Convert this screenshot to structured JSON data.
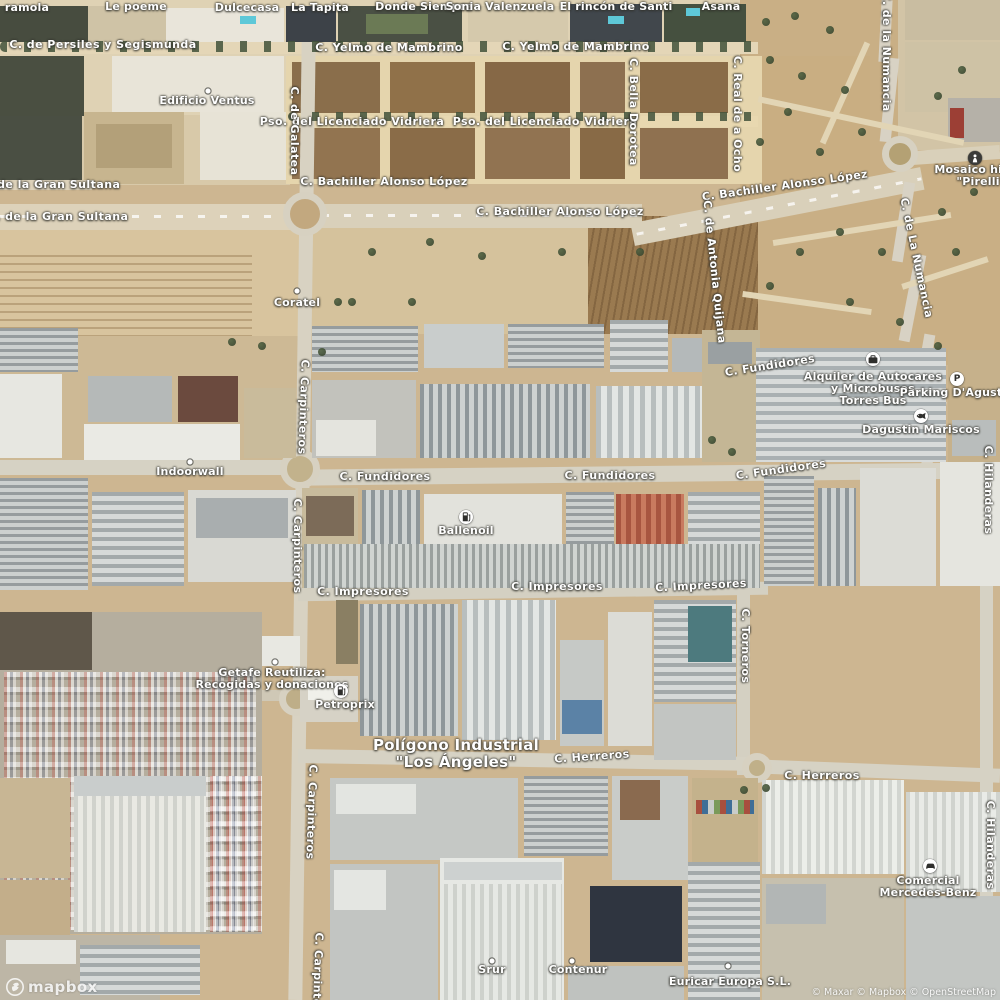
{
  "map": {
    "provider_logo": "mapbox",
    "attribution": "© Maxar © Mapbox © OpenStreetMap",
    "colors": {
      "label_text": "#ffffff",
      "label_halo": "#34342e",
      "marker_bg": "#ffffff",
      "marker_glyph": "#2f2f2d",
      "dark_marker_bg": "#3b3b39",
      "terrain_base": "#cdb691",
      "road": "#d6d2c4"
    },
    "place_labels": [
      {
        "lines": [
          "Polígono Industrial",
          "\"Los Ángeles\""
        ],
        "x": 456,
        "y": 754
      }
    ],
    "street_labels": [
      {
        "text": "C. de Persiles y Segismunda",
        "x": 103,
        "y": 45,
        "rot": 0
      },
      {
        "text": "C. Yelmo de Mambrino",
        "x": 389,
        "y": 48,
        "rot": 0
      },
      {
        "text": "C. Yelmo de Mambrino",
        "x": 576,
        "y": 47,
        "rot": 0
      },
      {
        "text": "Pso. del Licenciado Vidriera",
        "x": 352,
        "y": 122,
        "rot": 0
      },
      {
        "text": "Pso. del Licenciado Vidriera",
        "x": 545,
        "y": 122,
        "rot": 0
      },
      {
        "text": "C. Bachiller Alonso López",
        "x": 384,
        "y": 182,
        "rot": 0
      },
      {
        "text": "C. Bachiller Alonso López",
        "x": 560,
        "y": 212,
        "rot": 0
      },
      {
        "text": "C. Bachiller Alonso López",
        "x": 785,
        "y": 186,
        "rot": -8
      },
      {
        "text": "C. de la Gran Sultana",
        "x": 50,
        "y": 185,
        "rot": 0
      },
      {
        "text": "C. de la Gran Sultana",
        "x": 58,
        "y": 217,
        "rot": 0
      },
      {
        "text": "C. de la Numancia",
        "x": 886,
        "y": 52,
        "rot": 90
      },
      {
        "text": "C. de La Numancia",
        "x": 916,
        "y": 258,
        "rot": 78
      },
      {
        "text": "C. de Galatea",
        "x": 294,
        "y": 131,
        "rot": 90
      },
      {
        "text": "C. Bella Dorotea",
        "x": 633,
        "y": 112,
        "rot": 90
      },
      {
        "text": "C. Real de a Ocho",
        "x": 737,
        "y": 114,
        "rot": 90
      },
      {
        "text": "C. de Antonia Quijana",
        "x": 714,
        "y": 272,
        "rot": 84
      },
      {
        "text": "C. Fundidores",
        "x": 770,
        "y": 366,
        "rot": -9
      },
      {
        "text": "C. Fundidores",
        "x": 385,
        "y": 477,
        "rot": 0
      },
      {
        "text": "C. Fundidores",
        "x": 610,
        "y": 476,
        "rot": 0
      },
      {
        "text": "C. Fundidores",
        "x": 781,
        "y": 470,
        "rot": -8
      },
      {
        "text": "C. Carpinteros",
        "x": 303,
        "y": 407,
        "rot": 92
      },
      {
        "text": "C. Carpinteros",
        "x": 297,
        "y": 546,
        "rot": 90
      },
      {
        "text": "C. Carpinteros",
        "x": 311,
        "y": 812,
        "rot": 92
      },
      {
        "text": "C. Carpinteros",
        "x": 317,
        "y": 980,
        "rot": 92
      },
      {
        "text": "C. Impresores",
        "x": 363,
        "y": 592,
        "rot": 0
      },
      {
        "text": "C. Impresores",
        "x": 557,
        "y": 587,
        "rot": 0
      },
      {
        "text": "C. Impresores",
        "x": 701,
        "y": 586,
        "rot": -3
      },
      {
        "text": "C. Torneros",
        "x": 745,
        "y": 646,
        "rot": 90
      },
      {
        "text": "C. Herreros",
        "x": 592,
        "y": 757,
        "rot": -4
      },
      {
        "text": "C. Herreros",
        "x": 822,
        "y": 776,
        "rot": 0
      },
      {
        "text": "C. Hilanderas",
        "x": 988,
        "y": 490,
        "rot": 90
      },
      {
        "text": "C. Hilanderas",
        "x": 990,
        "y": 845,
        "rot": 90
      }
    ],
    "poi_labels": [
      {
        "lines": [
          "ramola"
        ],
        "x": 27,
        "y": 8,
        "icon": "none",
        "ix": 0,
        "iy": 0
      },
      {
        "lines": [
          "Le poeme"
        ],
        "x": 136,
        "y": 7,
        "icon": "none",
        "ix": 0,
        "iy": 0
      },
      {
        "lines": [
          "Dulcecasa"
        ],
        "x": 247,
        "y": 8,
        "icon": "none",
        "ix": 0,
        "iy": 0
      },
      {
        "lines": [
          "La Tapita"
        ],
        "x": 320,
        "y": 8,
        "icon": "none",
        "ix": 0,
        "iy": 0
      },
      {
        "lines": [
          "Donde Siempre"
        ],
        "x": 424,
        "y": 7,
        "icon": "none",
        "ix": 0,
        "iy": 0
      },
      {
        "lines": [
          "Sonia Valenzuela"
        ],
        "x": 500,
        "y": 7,
        "icon": "none",
        "ix": 0,
        "iy": 0
      },
      {
        "lines": [
          "El rincón de Santi"
        ],
        "x": 616,
        "y": 7,
        "icon": "none",
        "ix": 0,
        "iy": 0
      },
      {
        "lines": [
          "Asana"
        ],
        "x": 721,
        "y": 7,
        "icon": "none",
        "ix": 0,
        "iy": 0
      },
      {
        "lines": [
          "Edificio Ventus"
        ],
        "x": 207,
        "y": 101,
        "icon": "dot",
        "ix": 208,
        "iy": 91
      },
      {
        "lines": [
          "Coratel"
        ],
        "x": 297,
        "y": 303,
        "icon": "dot",
        "ix": 297,
        "iy": 291
      },
      {
        "lines": [
          "Mosaico histór",
          "\"Pirelli\""
        ],
        "x": 981,
        "y": 176,
        "icon": "monument",
        "ix": 975,
        "iy": 158
      },
      {
        "lines": [
          "Alquiler de Autocares",
          "y Microbuses",
          "Torres Bus"
        ],
        "x": 873,
        "y": 389,
        "icon": "bus",
        "ix": 873,
        "iy": 359
      },
      {
        "lines": [
          "Parking D'Agustín"
        ],
        "x": 957,
        "y": 393,
        "icon": "parking",
        "ix": 957,
        "iy": 379
      },
      {
        "lines": [
          "Dagustin Mariscos"
        ],
        "x": 921,
        "y": 430,
        "icon": "seafood",
        "ix": 921,
        "iy": 416
      },
      {
        "lines": [
          "Indoorwall"
        ],
        "x": 190,
        "y": 472,
        "icon": "dot",
        "ix": 190,
        "iy": 462
      },
      {
        "lines": [
          "Ballenoil"
        ],
        "x": 466,
        "y": 531,
        "icon": "fuel",
        "ix": 466,
        "iy": 517
      },
      {
        "lines": [
          "Getafe Reutiliza:",
          "Recogidas y donaciones"
        ],
        "x": 272,
        "y": 679,
        "icon": "dot",
        "ix": 275,
        "iy": 662
      },
      {
        "lines": [
          "Petroprix"
        ],
        "x": 345,
        "y": 705,
        "icon": "fuel",
        "ix": 341,
        "iy": 691
      },
      {
        "lines": [
          "Comercial",
          "Mercedes-Benz"
        ],
        "x": 928,
        "y": 887,
        "icon": "car",
        "ix": 930,
        "iy": 866
      },
      {
        "lines": [
          "Srur"
        ],
        "x": 492,
        "y": 970,
        "icon": "dot",
        "ix": 492,
        "iy": 961
      },
      {
        "lines": [
          "Contenur"
        ],
        "x": 578,
        "y": 970,
        "icon": "dot",
        "ix": 572,
        "iy": 961
      },
      {
        "lines": [
          "Euricar Europa S.L."
        ],
        "x": 730,
        "y": 982,
        "icon": "dot",
        "ix": 728,
        "iy": 966
      }
    ]
  }
}
